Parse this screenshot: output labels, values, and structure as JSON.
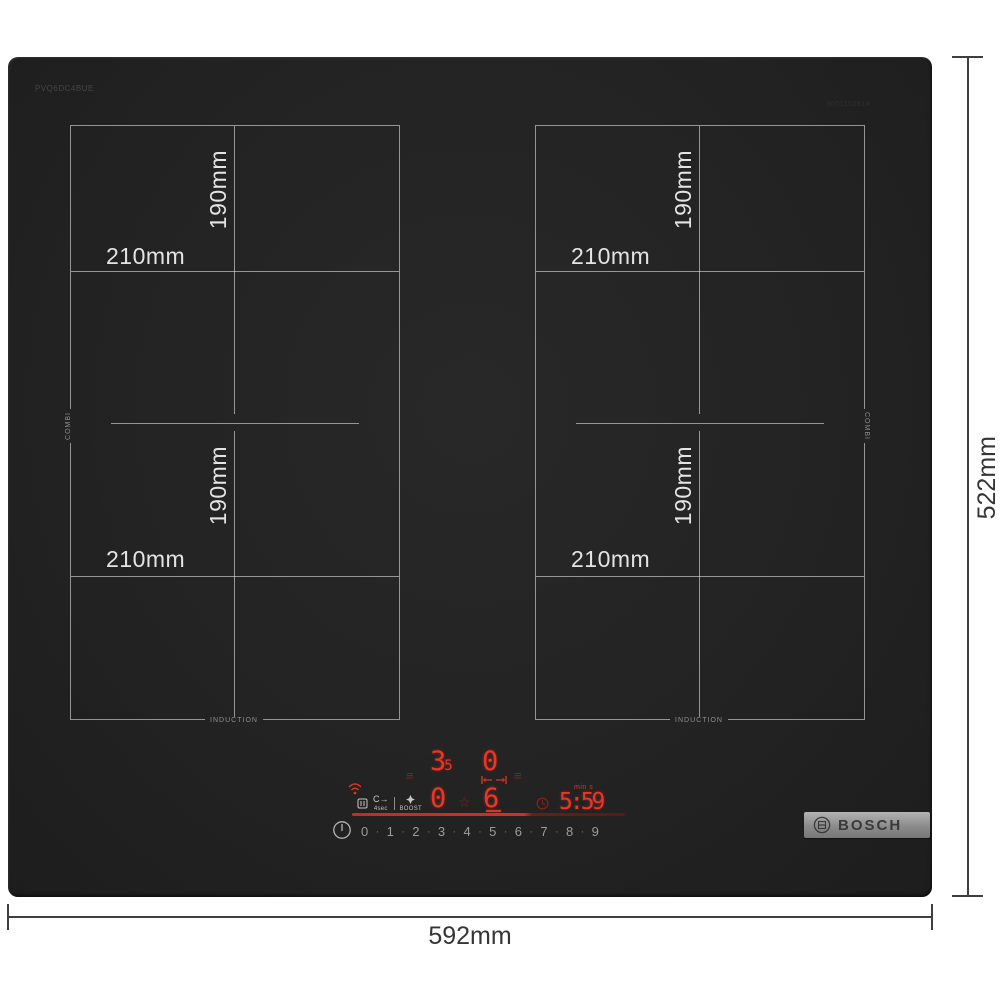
{
  "brand": {
    "name": "BOSCH"
  },
  "hob": {
    "model_code": "PVQ6DC4BUE",
    "part_code": "9001153814",
    "zone_labels": {
      "width": "210mm",
      "height": "190mm",
      "combi": "COMBI",
      "induction": "INDUCTION"
    }
  },
  "dimensions": {
    "width_label": "592mm",
    "height_label": "522mm"
  },
  "control_panel": {
    "zone_display_top": {
      "digit": "3",
      "small_digit": "5"
    },
    "zone_display_top_right": "0",
    "zone_display_bottom_left": "0",
    "zone_display_bridge": "6",
    "timer": {
      "unit_label": "min s",
      "value": "5:59"
    },
    "hold_glyph": "C→",
    "hold_label": "4sec",
    "boost_label": "BOOST",
    "power_levels": [
      "0",
      "1",
      "2",
      "3",
      "4",
      "5",
      "6",
      "7",
      "8",
      "9"
    ],
    "glyphs": {
      "menu_lines": "≡",
      "star": "☆",
      "separator": "·"
    }
  },
  "colors": {
    "surface": "#232323",
    "zone_line": "#dbdbdb",
    "led_red": "#ee3424",
    "dim_red": "#84231a",
    "dimension_ink": "#3f3f3f",
    "badge_metal": "#9a9a9a"
  }
}
